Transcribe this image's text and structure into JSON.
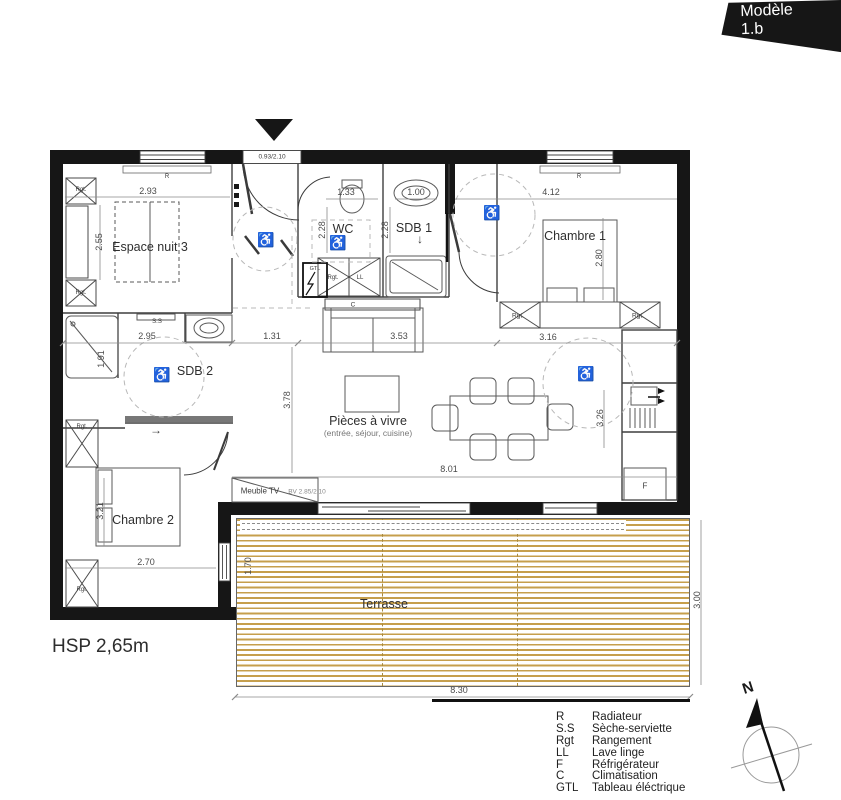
{
  "banner": {
    "label": "Modèle 1.b"
  },
  "colors": {
    "wall": "#161616",
    "deck": "#C69F4C",
    "partition": "#3F3F3F",
    "dimension": "#8A8A8A",
    "banner_bg": "#161616"
  },
  "plan": {
    "rooms": {
      "espace_nuit": "Espace nuit 3",
      "wc": "WC",
      "sdb1": "SDB 1",
      "chambre1": "Chambre 1",
      "sdb2": "SDB 2",
      "living": "Pièces à vivre",
      "living_sub": "(entrée, séjour, cuisine)",
      "chambre2": "Chambre 2",
      "terrasse": "Terrasse"
    },
    "dims": {
      "w293": "2.93",
      "w133": "1.33",
      "w100": "1.00",
      "w412": "4.12",
      "h255": "2.55",
      "h228": "2.28",
      "h280": "2.80",
      "w295": "2.95",
      "w131": "1.31",
      "w353": "3.53",
      "w316": "3.16",
      "h378": "3.78",
      "h191": "1.91",
      "h326": "3.26",
      "w801": "8.01",
      "h321": "3.21",
      "w270": "2.70",
      "h170": "1.70",
      "h300": "3.00",
      "w830": "8.30"
    },
    "labels": {
      "entry_door": "0.93/2.10",
      "bay": "BV 2.85/2.10",
      "meuble_tv": "Meuble TV",
      "radiator": "R",
      "seche": "S.S",
      "rangement": "Rgt.",
      "lave_linge": "LL",
      "gtl": "GTL",
      "clim": "C",
      "fridge": "F",
      "arrow_right": "→",
      "arrow_down": "↓",
      "wheelchair": "♿"
    }
  },
  "hsp_label": "HSP 2,65m",
  "north_label": "N",
  "legend": {
    "rows": [
      {
        "abbr": "R",
        "label": "Radiateur"
      },
      {
        "abbr": "S.S",
        "label": "Sèche-serviette"
      },
      {
        "abbr": "Rgt",
        "label": "Rangement"
      },
      {
        "abbr": "LL",
        "label": "Lave linge"
      },
      {
        "abbr": "F",
        "label": "Réfrigérateur"
      },
      {
        "abbr": "C",
        "label": "Climatisation"
      },
      {
        "abbr": "GTL",
        "label": "Tableau éléctrique"
      }
    ]
  }
}
